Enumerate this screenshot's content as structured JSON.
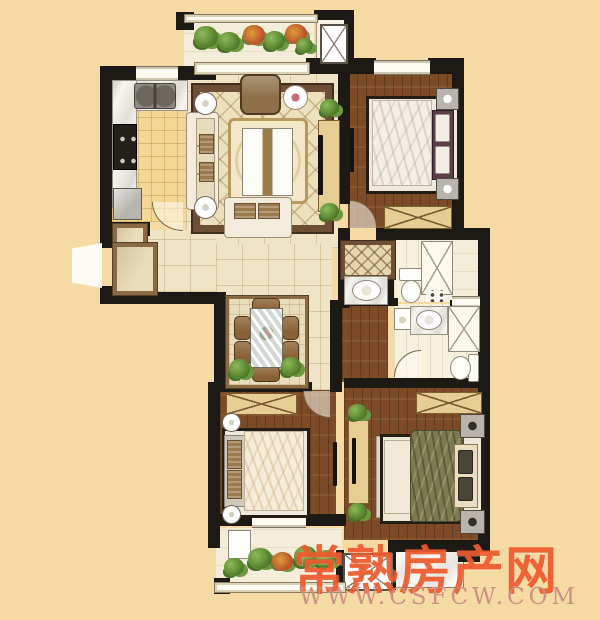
{
  "watermark": {
    "title": "常熟房产网",
    "url": "WWW.CSFCW.COM"
  },
  "palette": {
    "background": "#F6DAA3",
    "wall": "#1D1A15",
    "wood_floor": "#7C4A26",
    "tile_floor": "#F0E4C6",
    "kitchen_floor": "#F3D795",
    "rug_border": "#6E4E35",
    "cabinet_tan": "#E6CD94",
    "headboard_maroon": "#5C3C46",
    "duvet_olive": "#7C7A50",
    "watermark_red": "#EE5A2E",
    "watermark_url": "#C98E85"
  }
}
